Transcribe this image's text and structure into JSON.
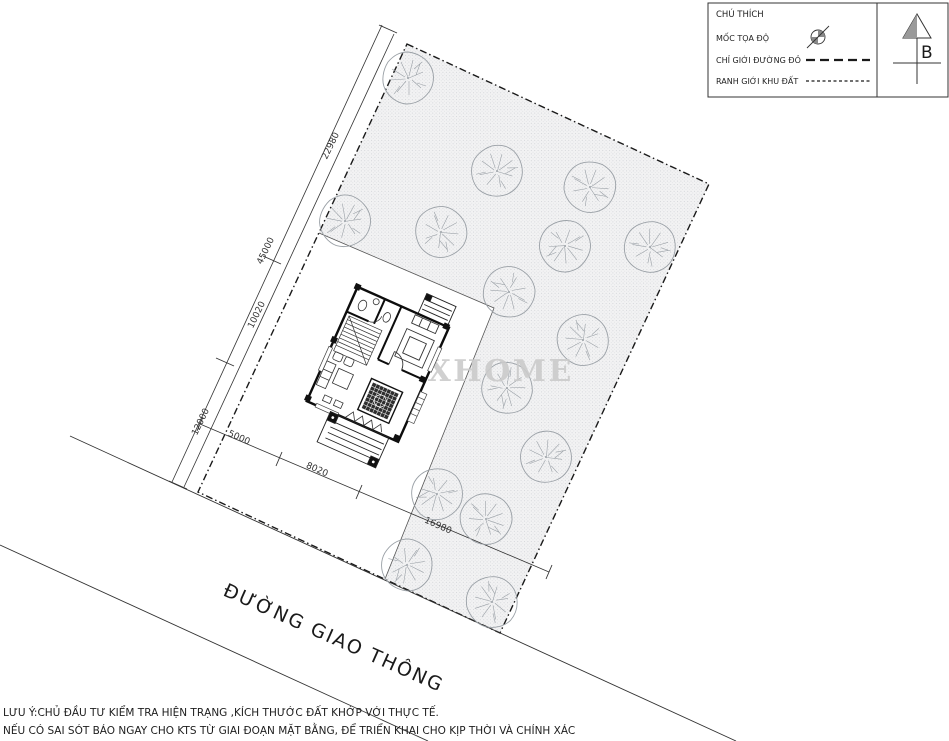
{
  "legend": {
    "title": "CHÚ THÍCH",
    "items": [
      {
        "label": "MỐC TỌA ĐỘ",
        "symbol": "survey-marker-icon"
      },
      {
        "label": "CHỈ GIỚI ĐƯỜNG ĐỎ",
        "symbol": "dashed-line-sample"
      },
      {
        "label": "RANH GIỚI KHU ĐẤT",
        "symbol": "dash-dot-line-sample"
      }
    ]
  },
  "north": {
    "label": "B"
  },
  "site": {
    "road_label": "ĐƯỜNG GIAO THÔNG",
    "watermark": "MAXHOME",
    "dimensions": {
      "left_total": "45000",
      "left_segments": [
        "22980",
        "10020",
        "12000"
      ],
      "bottom_segments": [
        "5000",
        "8020",
        "16980"
      ]
    }
  },
  "notes": [
    "LƯU Ý:CHỦ ĐẦU TƯ KIỂM TRA HIỆN TRẠNG ,KÍCH THƯỚC ĐẤT KHỚP VỚI THỰC TẾ.",
    "NẾU CÓ SAI SÓT BÁO NGAY CHO KTS TỪ GIAI ĐOẠN MẶT BẰNG, ĐỂ TRIỂN KHAI CHO KỊP THỜI VÀ CHÍNH XÁC"
  ],
  "colors": {
    "line": "#1a1a1a",
    "tree": "#9aa0a6",
    "stipple_dot": "#bfc3c7",
    "watermark": "#cbcbcb"
  }
}
